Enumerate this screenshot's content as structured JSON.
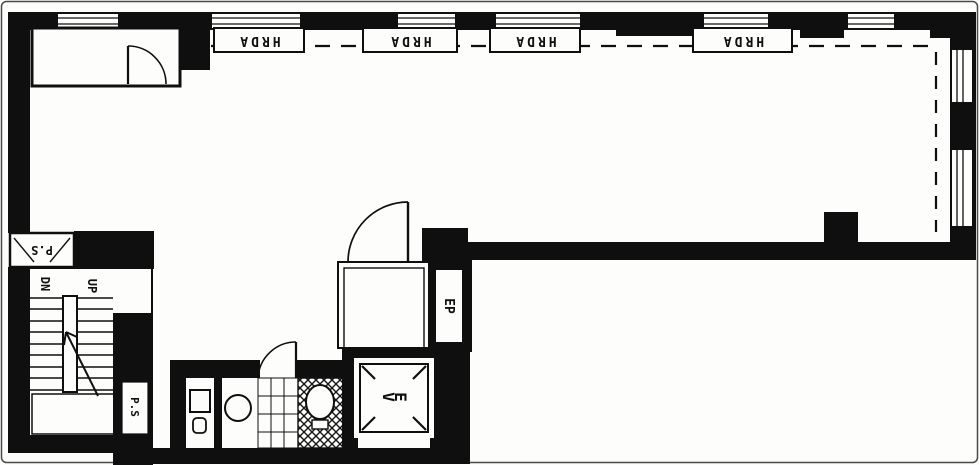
{
  "plan": {
    "perimeter_units": {
      "labels": [
        "HRDA",
        "HRDA",
        "HRDA",
        "HRDA"
      ]
    },
    "stairs": {
      "down_label": "DN",
      "up_label": "UP"
    },
    "shafts": {
      "pipe_shaft_top_label": "P.S",
      "pipe_shaft_lower_label": "P.S",
      "electrical_panel_label": "EP"
    },
    "elevator": {
      "label": "EV"
    },
    "ink_color": "#0f0f0f",
    "paper_color": "#fdfdfc"
  }
}
